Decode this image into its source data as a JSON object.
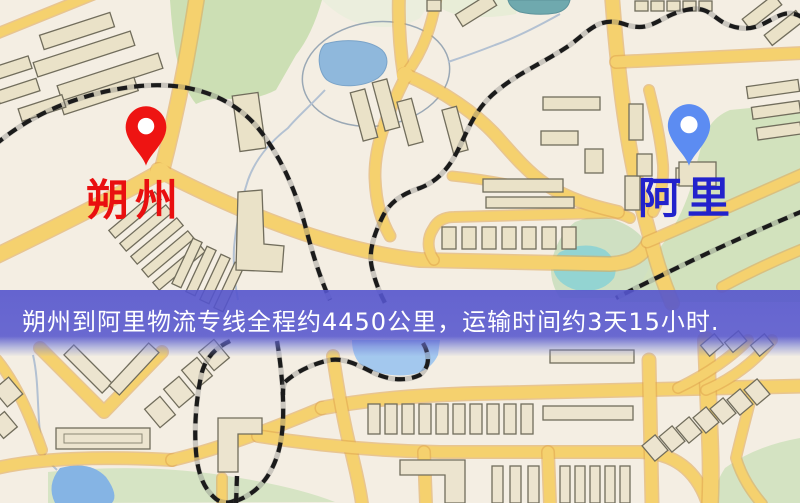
{
  "map": {
    "origin": {
      "label": "朔州",
      "label_color": "#e90f0f",
      "pin_color": "#ee1412"
    },
    "destination": {
      "label": "阿里",
      "label_color": "#2222cc",
      "pin_color": "#5c8cf2"
    }
  },
  "banner": {
    "text": "朔州到阿里物流专线全程约4450公里，运输时间约3天15小时.",
    "background_color": "#5555cd",
    "text_color": "#ffffff"
  }
}
